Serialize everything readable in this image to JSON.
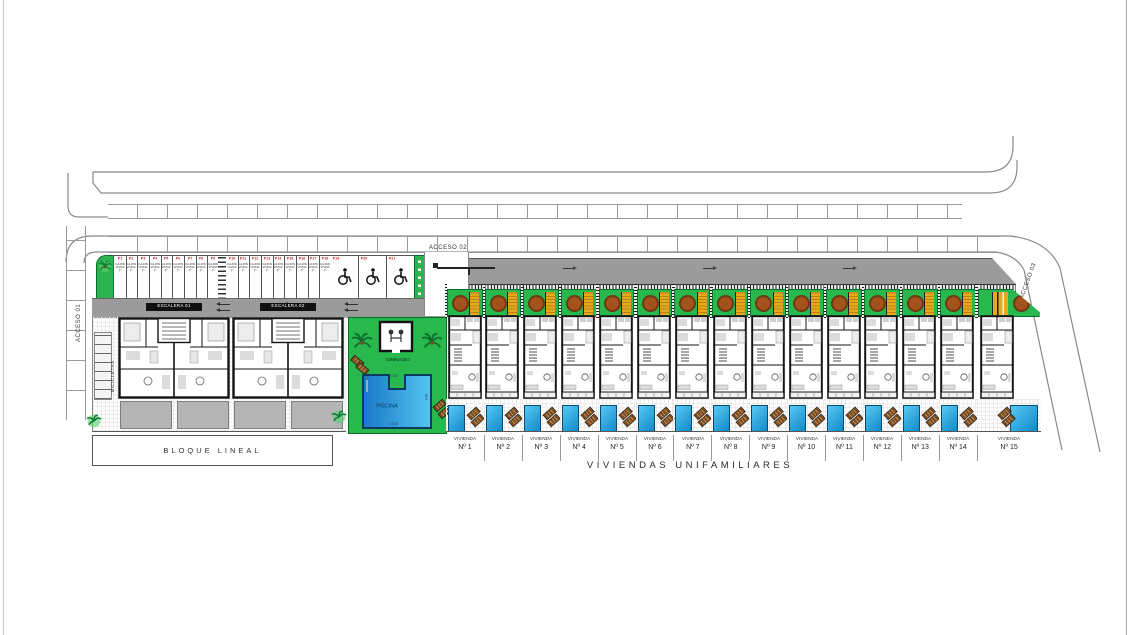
{
  "plan": {
    "accesses": {
      "a1": "ACCESO 01",
      "a2": "ACCESO 02",
      "a3": "ACCESO 03"
    },
    "apartments": {
      "escaleras": [
        "ESCALERA 01",
        "ESCALERA 02"
      ],
      "bicicletas": "BICICLETAS",
      "bloque": "BLOQUE LINEAL"
    },
    "amenities": {
      "gym": "GIMNASIO",
      "pool": "PISCINA",
      "pool_dims": {
        "top": "4,06",
        "side": "4,06",
        "bottom": "10,06"
      }
    },
    "parking": {
      "group_a": [
        "P1",
        "P2",
        "P3",
        "P4",
        "P5",
        "P6",
        "P7",
        "P8",
        "P9"
      ],
      "group_b": [
        "P10",
        "P11",
        "P12",
        "P13",
        "P14",
        "P15",
        "P16",
        "P17",
        "P18"
      ],
      "disabled": [
        "P19",
        "P20",
        "P21"
      ],
      "stall_lines": [
        "CAJON",
        "VIVDA",
        "Tº"
      ]
    },
    "villas": {
      "word": "VIVIENDA",
      "units": [
        "Nº 1",
        "Nº 2",
        "Nº 3",
        "Nº 4",
        "Nº 5",
        "Nº 6",
        "Nº 7",
        "Nº 8",
        "Nº 9",
        "Nº 10",
        "Nº 11",
        "Nº 12",
        "Nº 13",
        "Nº 14",
        "Nº 15"
      ],
      "title": "VIVIENDAS UNIFAMILIARES"
    },
    "colors": {
      "garden_green": "#28b84d",
      "pergola_yellow": "#e8a91f",
      "pool_blue": "#1e8fd0",
      "road_gray": "#9b9b9b",
      "stall_red": "#c42222"
    }
  }
}
